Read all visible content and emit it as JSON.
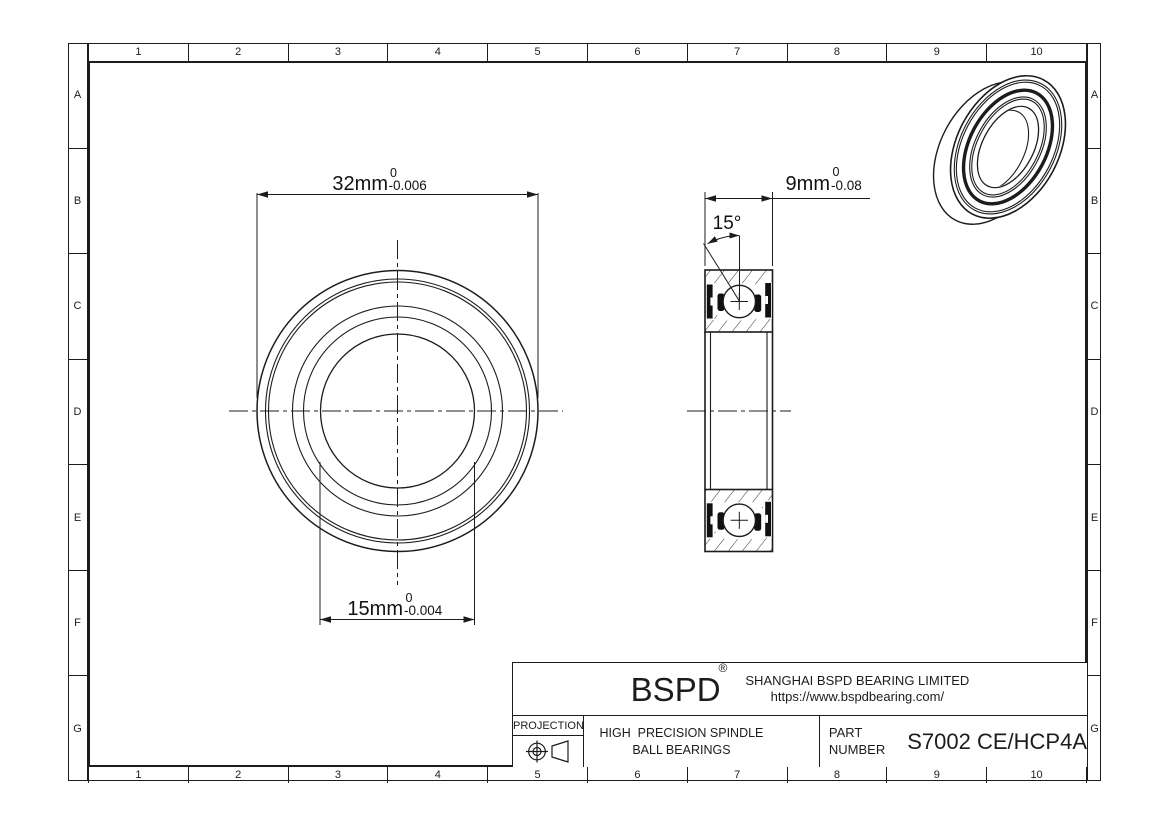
{
  "sheet": {
    "columns": [
      "1",
      "2",
      "3",
      "4",
      "5",
      "6",
      "7",
      "8",
      "9",
      "10"
    ],
    "rows": [
      "A",
      "B",
      "C",
      "D",
      "E",
      "F",
      "G"
    ]
  },
  "dimensions": {
    "outer_diameter": {
      "value": "32mm",
      "tol_upper": "0",
      "tol_lower": "-0.006"
    },
    "bore_diameter": {
      "value": "15mm",
      "tol_upper": "0",
      "tol_lower": "-0.004"
    },
    "width": {
      "value": "9mm",
      "tol_upper": "0",
      "tol_lower": "-0.08"
    },
    "contact_angle": {
      "value": "15°"
    }
  },
  "title_block": {
    "logo": "BSPD",
    "reg_mark": "®",
    "company": "SHANGHAI BSPD BEARING LIMITED",
    "website": "https://www.bspdbearing.com/",
    "projection_label": "PROJECTION",
    "product_line1": "HIGH  PRECISION SPINDLE",
    "product_line2": "BALL BEARINGS",
    "part_label_line1": "PART",
    "part_label_line2": "NUMBER",
    "part_number": "S7002 CE/HCP4A"
  },
  "colors": {
    "line": "#1c1c1c",
    "seal": "#111111",
    "background": "#ffffff"
  }
}
